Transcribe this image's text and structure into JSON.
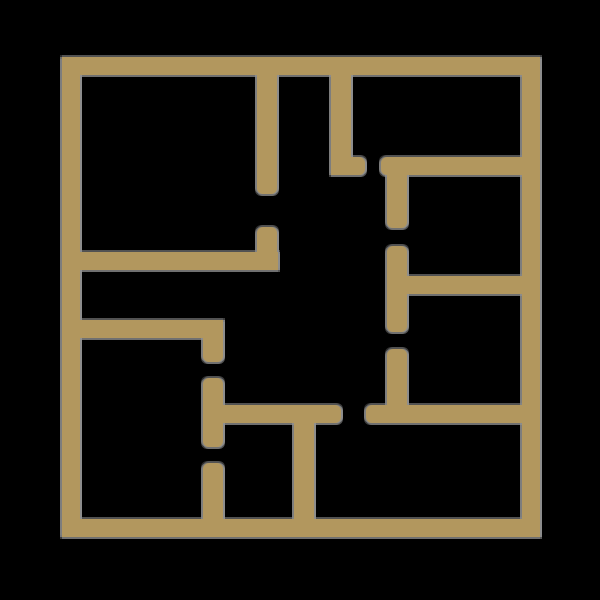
{
  "canvas": {
    "width": 600,
    "height": 600,
    "background_color": "#000000"
  },
  "floorplan": {
    "description": "single-story floor plan outline drawing, gold walls on black background, no text labels",
    "wall_color": "#b2975e",
    "outline_color": "#969696",
    "wall_thickness_px": 18,
    "walls": [
      {
        "id": "outer-top",
        "x": 62,
        "y": 57,
        "w": 478,
        "h": 18,
        "r": [
          0,
          0,
          0,
          0
        ]
      },
      {
        "id": "outer-left",
        "x": 62,
        "y": 57,
        "w": 18,
        "h": 480,
        "r": [
          0,
          0,
          0,
          0
        ]
      },
      {
        "id": "outer-right",
        "x": 522,
        "y": 57,
        "w": 18,
        "h": 480,
        "r": [
          0,
          0,
          0,
          0
        ]
      },
      {
        "id": "outer-bottom",
        "x": 62,
        "y": 519,
        "w": 478,
        "h": 18,
        "r": [
          0,
          0,
          0,
          0
        ]
      },
      {
        "id": "top-center-vertical-upper",
        "x": 257,
        "y": 75,
        "w": 20,
        "h": 119,
        "r": [
          0,
          0,
          6,
          6
        ]
      },
      {
        "id": "top-center-vertical-stub",
        "x": 257,
        "y": 227,
        "w": 20,
        "h": 43,
        "r": [
          6,
          6,
          0,
          0
        ]
      },
      {
        "id": "left-horizontal-upper",
        "x": 70,
        "y": 252,
        "w": 208,
        "h": 18,
        "r": [
          0,
          0,
          0,
          0
        ]
      },
      {
        "id": "top-right-vertical",
        "x": 331,
        "y": 75,
        "w": 20,
        "h": 100,
        "r": [
          0,
          0,
          0,
          6
        ]
      },
      {
        "id": "top-right-vertical-foot",
        "x": 331,
        "y": 157,
        "w": 34,
        "h": 18,
        "r": [
          0,
          6,
          6,
          0
        ]
      },
      {
        "id": "top-right-horizontal",
        "x": 381,
        "y": 157,
        "w": 141,
        "h": 18,
        "r": [
          6,
          0,
          0,
          6
        ]
      },
      {
        "id": "right-divider-seg1",
        "x": 387,
        "y": 175,
        "w": 20,
        "h": 53,
        "r": [
          0,
          0,
          6,
          6
        ]
      },
      {
        "id": "right-divider-seg2",
        "x": 387,
        "y": 246,
        "w": 20,
        "h": 86,
        "r": [
          6,
          6,
          6,
          6
        ]
      },
      {
        "id": "right-middle-horizontal",
        "x": 402,
        "y": 276,
        "w": 120,
        "h": 18,
        "r": [
          0,
          0,
          0,
          0
        ]
      },
      {
        "id": "right-divider-seg3",
        "x": 387,
        "y": 349,
        "w": 20,
        "h": 74,
        "r": [
          6,
          6,
          0,
          0
        ]
      },
      {
        "id": "lower-horizontal-right",
        "x": 366,
        "y": 405,
        "w": 156,
        "h": 18,
        "r": [
          6,
          0,
          0,
          6
        ]
      },
      {
        "id": "lower-horizontal-left",
        "x": 223,
        "y": 405,
        "w": 118,
        "h": 18,
        "r": [
          0,
          6,
          6,
          0
        ]
      },
      {
        "id": "left-horizontal-lower",
        "x": 70,
        "y": 320,
        "w": 153,
        "h": 18,
        "r": [
          0,
          0,
          0,
          0
        ]
      },
      {
        "id": "left-divider-seg1",
        "x": 203,
        "y": 338,
        "w": 20,
        "h": 24,
        "r": [
          0,
          0,
          6,
          6
        ]
      },
      {
        "id": "left-divider-seg2",
        "x": 203,
        "y": 378,
        "w": 20,
        "h": 69,
        "r": [
          6,
          6,
          6,
          6
        ]
      },
      {
        "id": "left-divider-seg3",
        "x": 203,
        "y": 463,
        "w": 20,
        "h": 60,
        "r": [
          6,
          6,
          0,
          0
        ]
      },
      {
        "id": "bottom-center-vertical",
        "x": 294,
        "y": 423,
        "w": 20,
        "h": 100,
        "r": [
          0,
          0,
          0,
          0
        ]
      }
    ],
    "door_openings": [
      {
        "id": "opening-top-left-room",
        "x": 257,
        "y": 194,
        "w": 20,
        "h": 33
      },
      {
        "id": "opening-top-right-room",
        "x": 365,
        "y": 157,
        "w": 16,
        "h": 18
      },
      {
        "id": "opening-right-upper-room",
        "x": 387,
        "y": 228,
        "w": 20,
        "h": 18
      },
      {
        "id": "opening-right-lower-room",
        "x": 387,
        "y": 332,
        "w": 20,
        "h": 17
      },
      {
        "id": "opening-left-room",
        "x": 203,
        "y": 362,
        "w": 20,
        "h": 16
      },
      {
        "id": "opening-bottom-middle-room",
        "x": 203,
        "y": 447,
        "w": 20,
        "h": 16
      },
      {
        "id": "opening-bottom-right-room",
        "x": 341,
        "y": 405,
        "w": 25,
        "h": 18
      }
    ]
  }
}
